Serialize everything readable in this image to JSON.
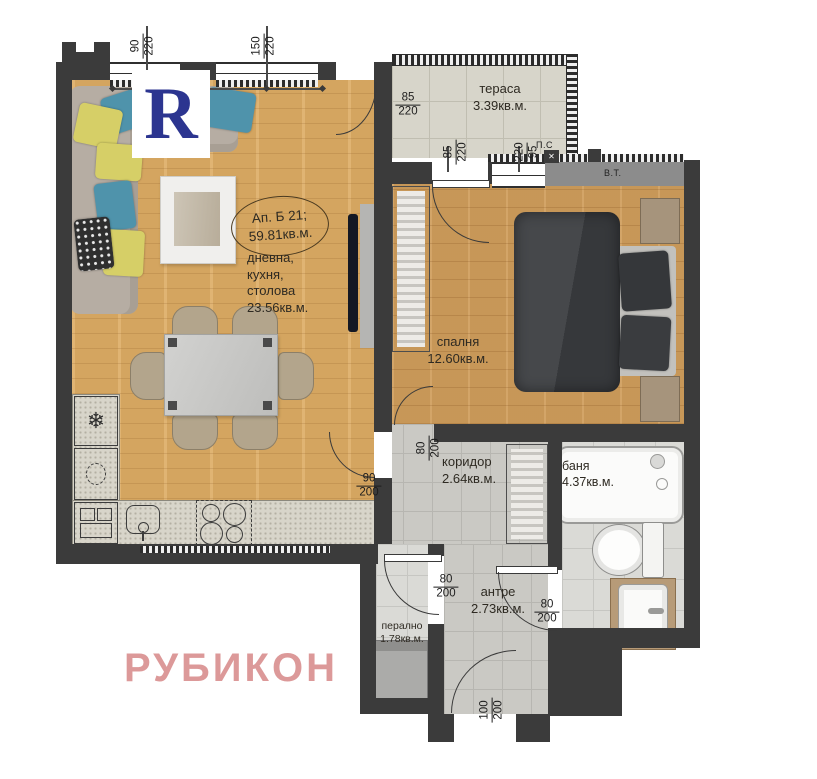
{
  "watermark": {
    "text": "РУБИКОН",
    "color": "#d98f8f"
  },
  "logo": {
    "letter": "R",
    "color": "#2c3590"
  },
  "apartment_label": {
    "line1": "Ап. Б 21;",
    "line2": "59.81кв.м."
  },
  "rooms": {
    "living": {
      "l1": "дневна,",
      "l2": "кухня,",
      "l3": "столова",
      "area": "23.56кв.м."
    },
    "terrace": {
      "name": "тераса",
      "area": "3.39кв.м."
    },
    "bedroom": {
      "name": "спалня",
      "area": "12.60кв.м."
    },
    "corridor": {
      "name": "коридор",
      "area": "2.64кв.м."
    },
    "bathroom": {
      "name": "баня",
      "area": "4.37кв.м."
    },
    "antre": {
      "name": "антре",
      "area": "2.73кв.м."
    },
    "laundry": {
      "name": "перално",
      "area": "1.78кв.м."
    }
  },
  "dims": {
    "win1": {
      "w": "90",
      "h": "220"
    },
    "win2": {
      "w": "150",
      "h": "220"
    },
    "terrace_door": {
      "w": "85",
      "h": "220"
    },
    "terrace_win1": {
      "w": "85",
      "h": "220"
    },
    "terrace_win2": {
      "w": "220",
      "h": "95"
    },
    "living_door": {
      "w": "90",
      "h": "200"
    },
    "bedroom_door": {
      "w": "80",
      "h": "200"
    },
    "laundry_door": {
      "w": "80",
      "h": "200"
    },
    "bathroom_door": {
      "w": "80",
      "h": "200"
    },
    "entrance_door": {
      "w": "100",
      "h": "200"
    }
  },
  "markers": {
    "floor_drain": "П.С",
    "vent": "В.Т."
  },
  "colors": {
    "wall": "#3b3b3b",
    "wood": "#dcab63",
    "watermark": "#d98f8f",
    "logo_blue": "#2c3590"
  }
}
